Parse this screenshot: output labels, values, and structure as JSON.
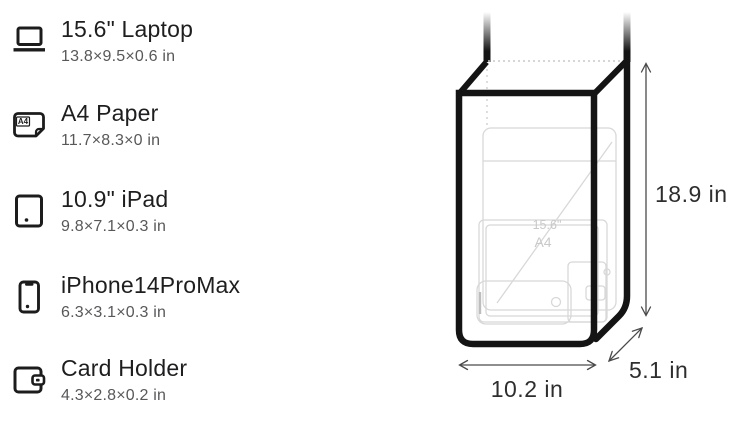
{
  "page": {
    "background": "#ffffff"
  },
  "items": [
    {
      "name": "15.6\" Laptop",
      "dims": "13.8×9.5×0.6 in",
      "icon": "laptop-icon"
    },
    {
      "name": "A4 Paper",
      "dims": "11.7×8.3×0 in",
      "icon": "a4-paper-icon"
    },
    {
      "name": "10.9\" iPad",
      "dims": "9.8×7.1×0.3 in",
      "icon": "ipad-icon"
    },
    {
      "name": "iPhone14ProMax",
      "dims": "6.3×3.1×0.3 in",
      "icon": "iphone-icon"
    },
    {
      "name": "Card Holder",
      "dims": "4.3×2.8×0.2 in",
      "icon": "wallet-icon"
    }
  ],
  "a4_icon_label": "A4",
  "bag": {
    "height_label": "18.9 in",
    "width_label": "10.2 in",
    "depth_label": "5.1 in",
    "inside_labels": {
      "laptop": "15.6\"",
      "paper": "A4"
    },
    "colors": {
      "outline": "#141414",
      "interior_lines": "#d8d8d8",
      "interior_text": "#c9c9c9",
      "dimension_line": "#4a4a4a",
      "dimension_text": "#2e2e2e",
      "dotted_edge": "#c9c9c9"
    }
  }
}
